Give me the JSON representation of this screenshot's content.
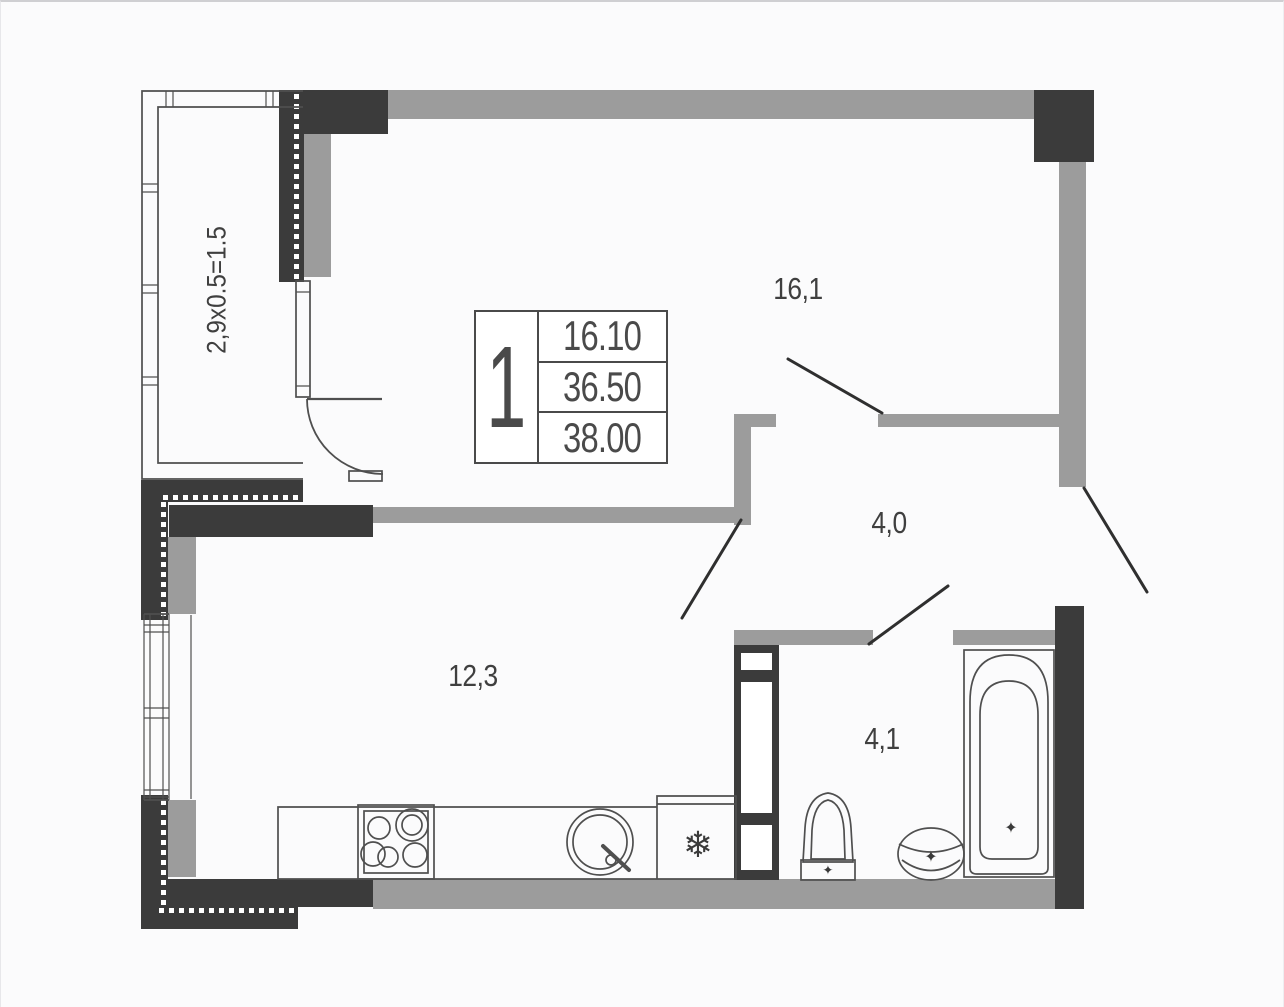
{
  "stamp": {
    "unit_number": "1",
    "rows": [
      "16.10",
      "36.50",
      "38.00"
    ]
  },
  "rooms": {
    "living": {
      "label": "16,1"
    },
    "hall": {
      "label": "4,0"
    },
    "kitchen": {
      "label": "12,3"
    },
    "bathroom": {
      "label": "4,1"
    },
    "balcony": {
      "label": "2,9x0.5=1.5"
    }
  },
  "icons": {
    "fridge_glyph": "❄",
    "drain_glyph": "✦",
    "basin_faucet_glyph": "✦",
    "toilet_valve_glyph": "✦"
  },
  "colors": {
    "wall_dark": "#3b3b3b",
    "wall_gray": "#9c9c9c",
    "line": "#4f4f4f",
    "text": "#3f3f3f"
  }
}
